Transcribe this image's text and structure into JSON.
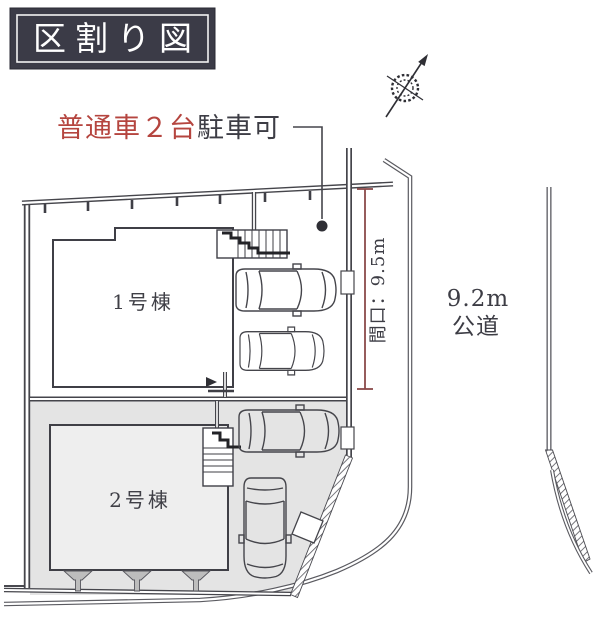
{
  "header": {
    "title": "区割り図"
  },
  "labels": {
    "parking_note_red": "普通車２台",
    "parking_note_dark": "駐車可",
    "building1": "1号棟",
    "building2": "2号棟",
    "frontage": "間口：9.5m",
    "road_width": "9.2m",
    "road_type": "公道"
  },
  "icons": {
    "compass": "north-arrow-icon",
    "stairs": "stairs-icon",
    "cars": "car-top-view-icon",
    "shrubs": "fence-post-icon"
  },
  "colors": {
    "header_bg": "#3b3b47",
    "header_text": "#ffffff",
    "accent_red": "#b5453f",
    "text_dark": "#3d3d45",
    "dimension_line": "#8a4a4a",
    "plot_fill": "#e4e4e4",
    "building_fill": "#eeeeee",
    "line_dark": "#3f3f46"
  }
}
